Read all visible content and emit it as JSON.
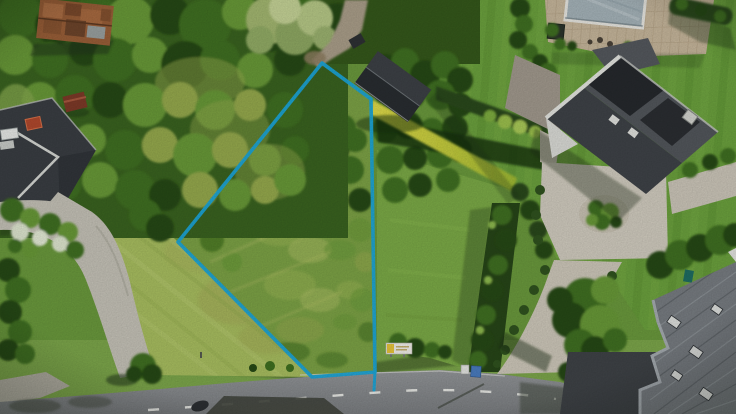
{
  "meta": {
    "kind": "aerial-drone-photo",
    "description": "Top-down aerial photo of a grassy building plot for sale, outlined with a bright blue boundary polygon, surrounded by wooded gardens, neighbouring houses with dark roofs, a swimming pool, gravel driveways, trimmed hedges and a country road with dashed centre markings along the bottom.",
    "image_width": 736,
    "image_height": 414
  },
  "annotation": {
    "type": "plot-boundary",
    "shape": "polygon",
    "points": "322,63 371,99 375,372 312,377 178,242",
    "tail_points": "375,372 374,390",
    "stroke_color": "#1ba7da",
    "stroke_width": "3.6"
  },
  "sign": {
    "name": "sale-sign",
    "board_color": "#f2f0ea",
    "accent_color": "#e8c53a"
  },
  "road": {
    "surface_color": "#8b8e91",
    "marking": "dashed-centre-line",
    "marking_color": "#e8e9e5"
  },
  "palette": {
    "forest_dark": "#264a15",
    "forest_mid": "#3f7020",
    "forest_light": "#699a39",
    "forest_bright": "#8fbc4f",
    "scrub": "#96aa4e",
    "plot_grass": "#7da346",
    "mowed_lawn": "#a9bf60",
    "right_lawn": "#6ca23e",
    "yellow_hedge": "#d8d23e",
    "roof_dark": "#464a4f",
    "roof_ridged": "#787d82",
    "driveway": "#d2cdc0",
    "pool_cover": "#a6b4ba",
    "patio": "#c7b79c",
    "rust_roof": "#9a5f38"
  },
  "scene": {
    "objects": [
      {
        "id": "plot",
        "label": "vacant grass plot inside blue boundary"
      },
      {
        "id": "boundary",
        "label": "blue plot boundary line"
      },
      {
        "id": "forest",
        "label": "dense trees and scrub left of plot"
      },
      {
        "id": "rust-barn",
        "label": "rusty-roof barn top left"
      },
      {
        "id": "left-house",
        "label": "dark-roof house with chimney, lower left"
      },
      {
        "id": "left-driveway",
        "label": "curved gravel driveway, left"
      },
      {
        "id": "mowed-lawn",
        "label": "mowed lawn between driveway and plot"
      },
      {
        "id": "garden",
        "label": "flowering garden beds, left"
      },
      {
        "id": "shed",
        "label": "dark garden shed at top right of plot"
      },
      {
        "id": "yellow-hedge",
        "label": "sunlit yellow hedge along plot"
      },
      {
        "id": "right-house",
        "label": "large dark-roof house, right"
      },
      {
        "id": "pool",
        "label": "covered swimming pool with patio, top right"
      },
      {
        "id": "right-driveway",
        "label": "light driveway with planted island, right"
      },
      {
        "id": "vertical-hedge",
        "label": "clipped hedge row right of plot"
      },
      {
        "id": "bottom-right-house",
        "label": "grey ridged-roof house, bottom right"
      },
      {
        "id": "road",
        "label": "asphalt road with dashed centre line, bottom"
      },
      {
        "id": "verge-tree",
        "label": "round tree on road verge"
      },
      {
        "id": "sale-sign",
        "label": "small white/yellow sign near plot entrance"
      },
      {
        "id": "bins",
        "label": "white and blue bins at road edge"
      }
    ]
  }
}
